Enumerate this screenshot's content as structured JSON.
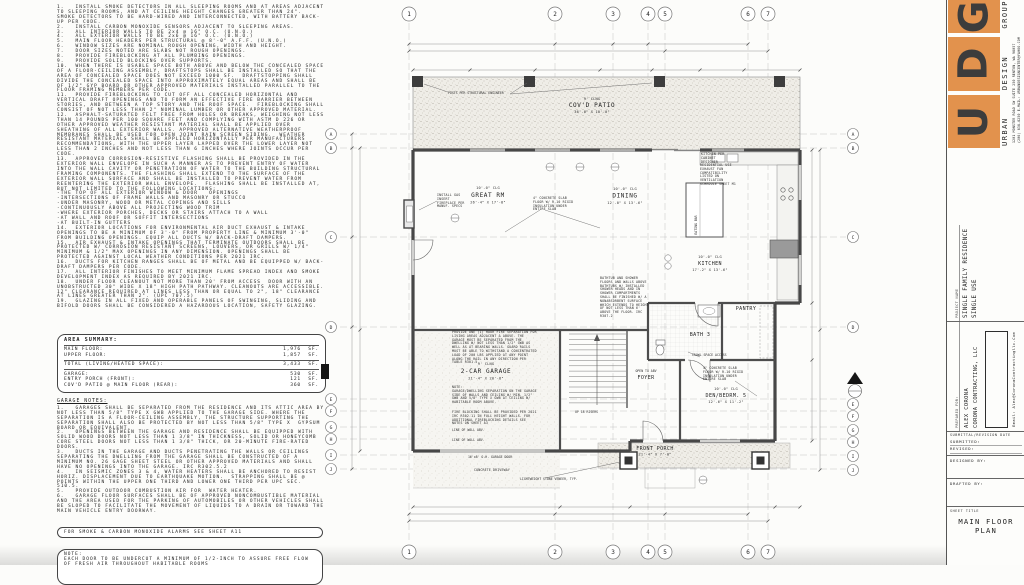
{
  "notes_panel": {
    "general_notes": [
      "1.   INSTALL SMOKE DETECTORS IN ALL SLEEPING ROOMS AND AT AREAS ADJACENT TO SLEEPING ROOMS, AND AT CEILING HEIGHT CHANGES GREATER THAN 24\".  SMOKE DETECTORS TO BE HARD-WIRED AND INTERCONNECTED, WITH BATTERY BACK-UP PER CODE.",
      "2.   INSTALL CARBON MONOXIDE SENSORS ADJACENT TO SLEEPING AREAS.",
      "3.   ALL INTERIOR WALLS TO BE 2x4 @ 16\" O.C. (U.N.O.)",
      "4.   ALL EXTERIOR WALLS TO BE 2x6 @ 16\" O.C. (U.N.O.)",
      "5.   MAIN FLOOR HEADERS PER STRUCTURAL @ 8'-0\" A.F.F. (U.N.O.)",
      "6.   WINDOW SIZES ARE NOMINAL ROUGH OPENING, WIDTH AND HEIGHT.",
      "7.   DOOR SIZES NOTED ARE SLABS NOT ROUGH OPENINGS.",
      "8.   PROVIDE FIREBLOCKING AT ALL PLUMBING OPENINGS.",
      "9.   PROVIDE SOLID BLOCKING OVER SUPPORTS.",
      "10.  WHEN THERE IS USABLE SPACE BOTH ABOVE AND BELOW THE CONCEALED SPACE OF A FLOOR-CEILING ASSEMBLY, DRAFTSTOPS SHALL BE INSTALLED SO THAT THE AREA OF CONCEALED SPACE DOES NOT EXCEED 1000 SF.  DRAFTSTOPPING SHALL DIVIDE THE CONCEALED SPACE INTO APPROXIMATELY EQUAL AREAS AND SHALL BE OF 1/2\" GYP BOARD OR OTHER APPROVED MATERIALS INSTALLED PARALLEL TO THE FLOOR FRAMING MEMBERS PER CODE.",
      "11.  PROVIDE FIREBLOCKING TO CUT OFF ALL CONCEALED HORIZONTAL AND VERTICAL DRAFT OPENINGS AND TO FORM AN EFFECTIVE FIRE BARRIER BETWEEN STORIES, AND BETWEEN A TOP STORY AND THE ROOF SPACE.  FIREBLOCKING SHALL CONSIST OF NOT LESS THAN 2\" NOMINAL LUMBER OR OTHER APPROVED MATERIAL.",
      "12.  ASPHALT-SATURATED FELT FREE FROM HOLES OR BREAKS, WEIGHING NOT LESS THAN 14 POUNDS PER 100 SQUARE FEET AND COMPLYING WITH ASTM D 226 OR OTHER APPROVED WEATHER RESISTANT MATERIAL SHALL BE APPLIED OVER SHEATHING OF ALL EXTERIOR WALLS. APPROVED ALTERNATIVE WEATHERPROOF MEMBRANES SHALL BE USED FOR OPEN JOINT RAIN SCREEN SIDING.  WEATHER RESISTANT MATERIALS SHALL BE APPLIED HORIZONTALLY PER MANUFACTURERS RECOMMENDATIONS, WITH THE UPPER LAYER LAPPED OVER THE LOWER LAYER NOT LESS THAN 2 INCHES AND NOT LESS THAN 6 INCHES WHERE JOINTS OCCUR PER CODE.",
      "13.  APPROVED CORROSION-RESISTIVE FLASHING SHALL BE PROVIDED IN THE EXTERIOR WALL ENVELOPE IN SUCH A MANNER AS TO PREVENT ENTRY OF WATER INTO THE WALL CAVITY OR PENETRATION OF WATER TO THE BUILDING STRUCTURAL FRAMING COMPONENTS. THE FLASHING SHALL EXTEND TO THE SURFACE OF THE EXTERIOR WALL SURFACE AND SHALL BE INSTALLED TO PREVENT WATER FROM REENTERING THE EXTERIOR WALL ENVELOPE.  FLASHING SHALL BE INSTALLED AT, BUT NOT LIMITED TO THE FOLLOWING LOCATIONS:\n-THE TOP OF ALL EXTERIOR WINDOW & DOOR   OPENINGS\n-INTERSECTIONS OF FRAME WALLS AND MASONRY OR STUCCO\n-UNDER MASONRY, WOOD OR METAL COPINGS AND SILLS\n-CONTINUOUSLY ABOVE ALL PROJECTING WOOD TRIM\n-WHERE EXTERIOR PORCHES, DECKS OR STAIRS ATTACH TO A WALL\n-AT WALL AND ROOF OR SOFFIT INTERSECTIONS\n-AT BUILT-IN GUTTERS",
      "14.  EXTERIOR LOCATIONS FOR ENVIRONMENTAL AIR DUCT EXHAUST & INTAKE OPENINGS TO BE A MINIMUM OF 3'-0\" FROM PROPERTY LINE & MINIMUM 3'-0\" FROM BUILDING OPENINGS. EQUIP ALL DUCTS W/ BACK-DRAFT DAMPERS.",
      "15.  AIR EXHAUST & INTAKE OPENINGS THAT TERMINATE OUTDOORS SHALL BE PROTECTED W/ CORROSION RESISTANT SCREENS, LOUVERS, OR GRILLS W/ 1/4\" MINIMUM & 1/2\" MAX OPENINGS IN ANY DIMENSION. OPENINGS SHALL BE PROTECTED AGAINST LOCAL WEATHER CONDITIONS PER 2021 IRC.",
      "16.  DUCTS FOR KITCHEN RANGES SHALL BE OF METAL AND BE EQUIPPED W/ BACK-DRAFT DAMPERS PER CODE.",
      "17.  ALL INTERIOR FINISHES TO MEET MINIMUM FLAME SPREAD INDEX AND SMOKE DEVELOPMENT INDEX AS REQUIRED BY 2021 IRC.",
      "18.  UNDER FLOOR CLEANOUT NOT MORE THAN 20' FROM ACCESS  DOOR WITH AN UNOBSTRUCTED 30\" WIDE X 18\" HIGH PATH PATHWAY. CLEANOUTS ARE ACCESSIBLE. 12\" CLEARANCE REQUIRED AT LINES LESS THAN OR EQUAL TO 2\", 18\" CLEARANCE AT LINES GREATER THAN 2\". (UPC 707.5)",
      "19.  GLAZING IN ALL FIXED AND OPERABLE PANELS OF SWINGING, SLIDING AND BIFOLD DOORS SHALL BE CONSIDERED A HAZARDOUS LOCATION, SAFETY GLAZING."
    ],
    "area_summary": {
      "title": "AREA SUMMARY:",
      "rows": [
        {
          "label": "MAIN FLOOR:",
          "value": "1,976",
          "unit": "SF."
        },
        {
          "label": "UPPER FLOOR:",
          "value": "1,857",
          "unit": "SF."
        }
      ],
      "total": {
        "label": "TOTAL (LIVING/HEATED SPACE):",
        "value": "3,433",
        "unit": "SF."
      },
      "extras": [
        {
          "label": "GARAGE:",
          "value": "530",
          "unit": "SF."
        },
        {
          "label": "ENTRY PORCH (FRONT):",
          "value": "121",
          "unit": "SF."
        },
        {
          "label": "COV'D PATIO @ MAIN FLOOR (REAR):",
          "value": "360",
          "unit": "SF."
        }
      ]
    },
    "garage_notes_title": "GARAGE NOTES:",
    "garage_notes": [
      "1.   GARAGES SHALL BE SEPARATED FROM THE RESIDENCE AND ITS ATTIC AREA BY NOT LESS THAN 5/8\" TYPE X GWB APPLIED TO THE GARAGE SIDE. WHERE THE SEPARATION IS A FLOOR-CEILING ASSEMBLY, THE STRUCTURE SUPPORTING THE SEPARATION SHALL ALSO BE PROTECTED BY NOT LESS THAN 5/8\" TYPE X  GYPSUM BOARD OR EQUIVALENT.",
      "2.   OPENINGS BETWEEN THE GARAGE AND RESIDENCE SHALL BE EQUIPPED WITH SOLID WOOD DOORS NOT LESS THAN 1 3/8\" IN THICKNESS, SOLID OR HONEYCOMB CORE STEEL DOORS NOT LESS THAN 1 3/8\" THICK, OR 20-MINUTE FIRE-RATED DOORS.",
      "3.   DUCTS IN THE GARAGE AND DUCTS PENETRATING THE WALLS OR CEILINGS SEPARATING THE DWELLING FROM THE GARAGE SHALL BE CONSTRUCTED OF A MINIMUM NO. 26 GAGE SHEET STEEL OR OTHER APPROVED MATERIALS AND SHALL HAVE NO OPENINGS INTO THE GARAGE. IRC R302.5.2",
      "4.   IN SEISMIC ZONES 3 & 4, WATER HEATERS SHALL BE ANCHORED TO RESIST HORIZ. DISPLACEMENT DUE TO EARTHQUAKE MOTION.  STRAPPING SHALL BE @ POINTS WITHIN THE UPPER ONE THIRD AND LOWER ONE THIRD PER UPC SEC. 510.5.",
      "5.   PROVIDE OUTDOOR COMBUSTION AIR FOR  WATER HEATER.",
      "6.   GARAGE FLOOR SURFACES SHALL BE OF APPROVED NONCOMBUSTIBLE MATERIAL AND THE AREA USED FOR THE PARKING OF AUTOMOBILES OR OTHER VEHICLES SHALL BE SLOPED TO FACILITATE THE MOVEMENT OF LIQUIDS TO A DRAIN OR TOWARD THE MAIN VEHICLE ENTRY DOORWAY."
    ],
    "alarm_note": "FOR SMOKE & CARBON MONOXIDE ALARMS SEE SHEET A11",
    "undercut_note": "NOTE:\nEACH DOOR TO BE UNDERCUT A MINIMUM OF 1/2-INCH TO ASSURE FREE FLOW OF FRESH AIR THROUGHOUT HABITABLE ROOMS"
  },
  "plan": {
    "grid": {
      "columns": [
        "1",
        "2",
        "3",
        "4",
        "5",
        "6",
        "7"
      ],
      "rows": [
        "A",
        "B",
        "C",
        "D",
        "E",
        "F",
        "G",
        "H",
        "I",
        "J"
      ]
    },
    "rooms": {
      "covd_patio": {
        "clg": "9' CLNG",
        "name": "COV'D PATIO",
        "dims": "36'-0\" X 10'-0\""
      },
      "great_rm": {
        "clg": "10'-0\" CLG",
        "name": "GREAT RM",
        "dims": "26'-4\" X 17'-8\""
      },
      "dining": {
        "clg": "10'-0\" CLG",
        "name": "DINING",
        "dims": "12'-0\" X 13'-6\""
      },
      "kitchen": {
        "clg": "10'-0\" CLG",
        "name": "KITCHEN",
        "dims": "17'-2\" X 13'-6\""
      },
      "pantry": {
        "name": "PANTRY"
      },
      "bath3": {
        "name": "BATH 3"
      },
      "foyer": {
        "note": "OPEN TO ABV",
        "name": "FOYER"
      },
      "den": {
        "clg": "10'-0\" CLG",
        "name": "DEN/BEDRM. 5",
        "dims": "12'-6\" X 11'-2\""
      },
      "garage": {
        "clg": "9' CLNG",
        "name": "2-CAR GARAGE",
        "dims": "21'-4\" X 20'-8\""
      },
      "front_porch": {
        "name": "FRONT PORCH",
        "dims": "21'-4\" X 7'-0\""
      }
    },
    "annotations": {
      "posts": "POSTS PER STRUCTURAL ENGINEER",
      "slab": "4\" CONCRETE SLAB FLOOR W/ R-10 RIGID INSULATION UNDER ENTIRE SLAB",
      "kitchen_cab": "KITCHEN PER CABINET DESIGNER",
      "fan": "RESIDENTIAL USE EXHAUST FAN COMPATIBILITY LISTED ON VENTILATION SCHEDULE SHEET M1",
      "bathtub": "BATHTUB AND SHOWER FLOORS AND WALLS ABOVE BATHTUBS W/ INSTALLED SHOWER HEADS AND IN SHOWER COMPARTMENTS SHALL BE FINISHED W/ A NONABSORBENT SURFACE WHICH EXTENDS TO HEIGHT OF NOT LESS THAN 6' ABOVE THE FLOOR. IRC R307.2",
      "garage_fire": "PROVIDE ONE (1) HOUR FIRE SEPARATION FOR LIVING AREAS ADJACENT & ABOVE. THE GARAGE MUST BE SEPARATED FROM THE DWELLING W/ NOT LESS THAN 1/2\" GWB AS WELL AS AT BEARING WALLS. GUARD RAILS MUST BE ABLE TO WITHSTAND A CONCENTRATED LOAD OF 200 LBS APPLIED AT ANY POINT ALONG THE RAIL IN ANY DIRECTION PER TABLE R301.5",
      "garage_sep": "NOTE:\nGARAGE/DWELLING SEPARATION ON THE GARAGE SIDE OF WALLS AND CEILING W/ MIN. 1/2\" GWB AND 5/8\" TYPE X GWB AT CEILING W/ HABITABLE ROOM ABOVE.",
      "fire_blocking": "FIRE BLOCKING SHALL BE PROVIDED PER 2021 IRC R302.11 IN FULL HEIGHT WALLS. FOR ADDITIONAL FIREBLOCKING DETAILS SEE NOTES ON SHEET A3",
      "line_abv": "LINE OF WALL ABV.",
      "garage_door": "16'x8' O.H. GARAGE DOOR",
      "driveway": "CONCRETE DRIVEWAY",
      "stone": "LIGHTWEIGHT STONE VENEER, TYP.",
      "crawl": "CRAWL SPACE ACCESS",
      "up_risers": "UP 18 RISERS",
      "eating_bar": "EATING BAR",
      "fireplace": "INSTALL GAS INSERT FIREPLACE PER MANUF. SPECS"
    }
  },
  "title_block": {
    "logo": {
      "letter_u": "U",
      "letter_d": "D",
      "letter_g": "G",
      "word_urban": "URBAN",
      "word_design": "DESIGN",
      "word_group": "GROUP",
      "address1": "1201 MONSTER ROAD SW SUITE 250 RENTON, WA 98057",
      "address2": "(206) 838-8250 E-MAIL: URBANDESIGNCENTER@YAHOO.COM",
      "orange": "#e2924d"
    },
    "project_name_label": "PROJECT NAME",
    "project_name": "SINGLE FAMILY RESIDENCE",
    "project_use": "SINGLE USE",
    "prepared_for_label": "PREPARED FOR:",
    "client_line1": "ALEX CORONA",
    "client_line2": "CORONA CONTRACTING, LLC",
    "email": "Email: Alex@CoronaContractingllc.Com",
    "submittal_label": "SUBMITTAL/REVISION   DATE",
    "submitted_label": "SUBMITTED:",
    "revised_label": "REVISED:",
    "designed_label": "DESIGNED BY:",
    "drafted_label": "DRAFTED BY:",
    "sheet_title_label": "SHEET TITLE",
    "sheet_title": "MAIN FLOOR PLAN"
  }
}
